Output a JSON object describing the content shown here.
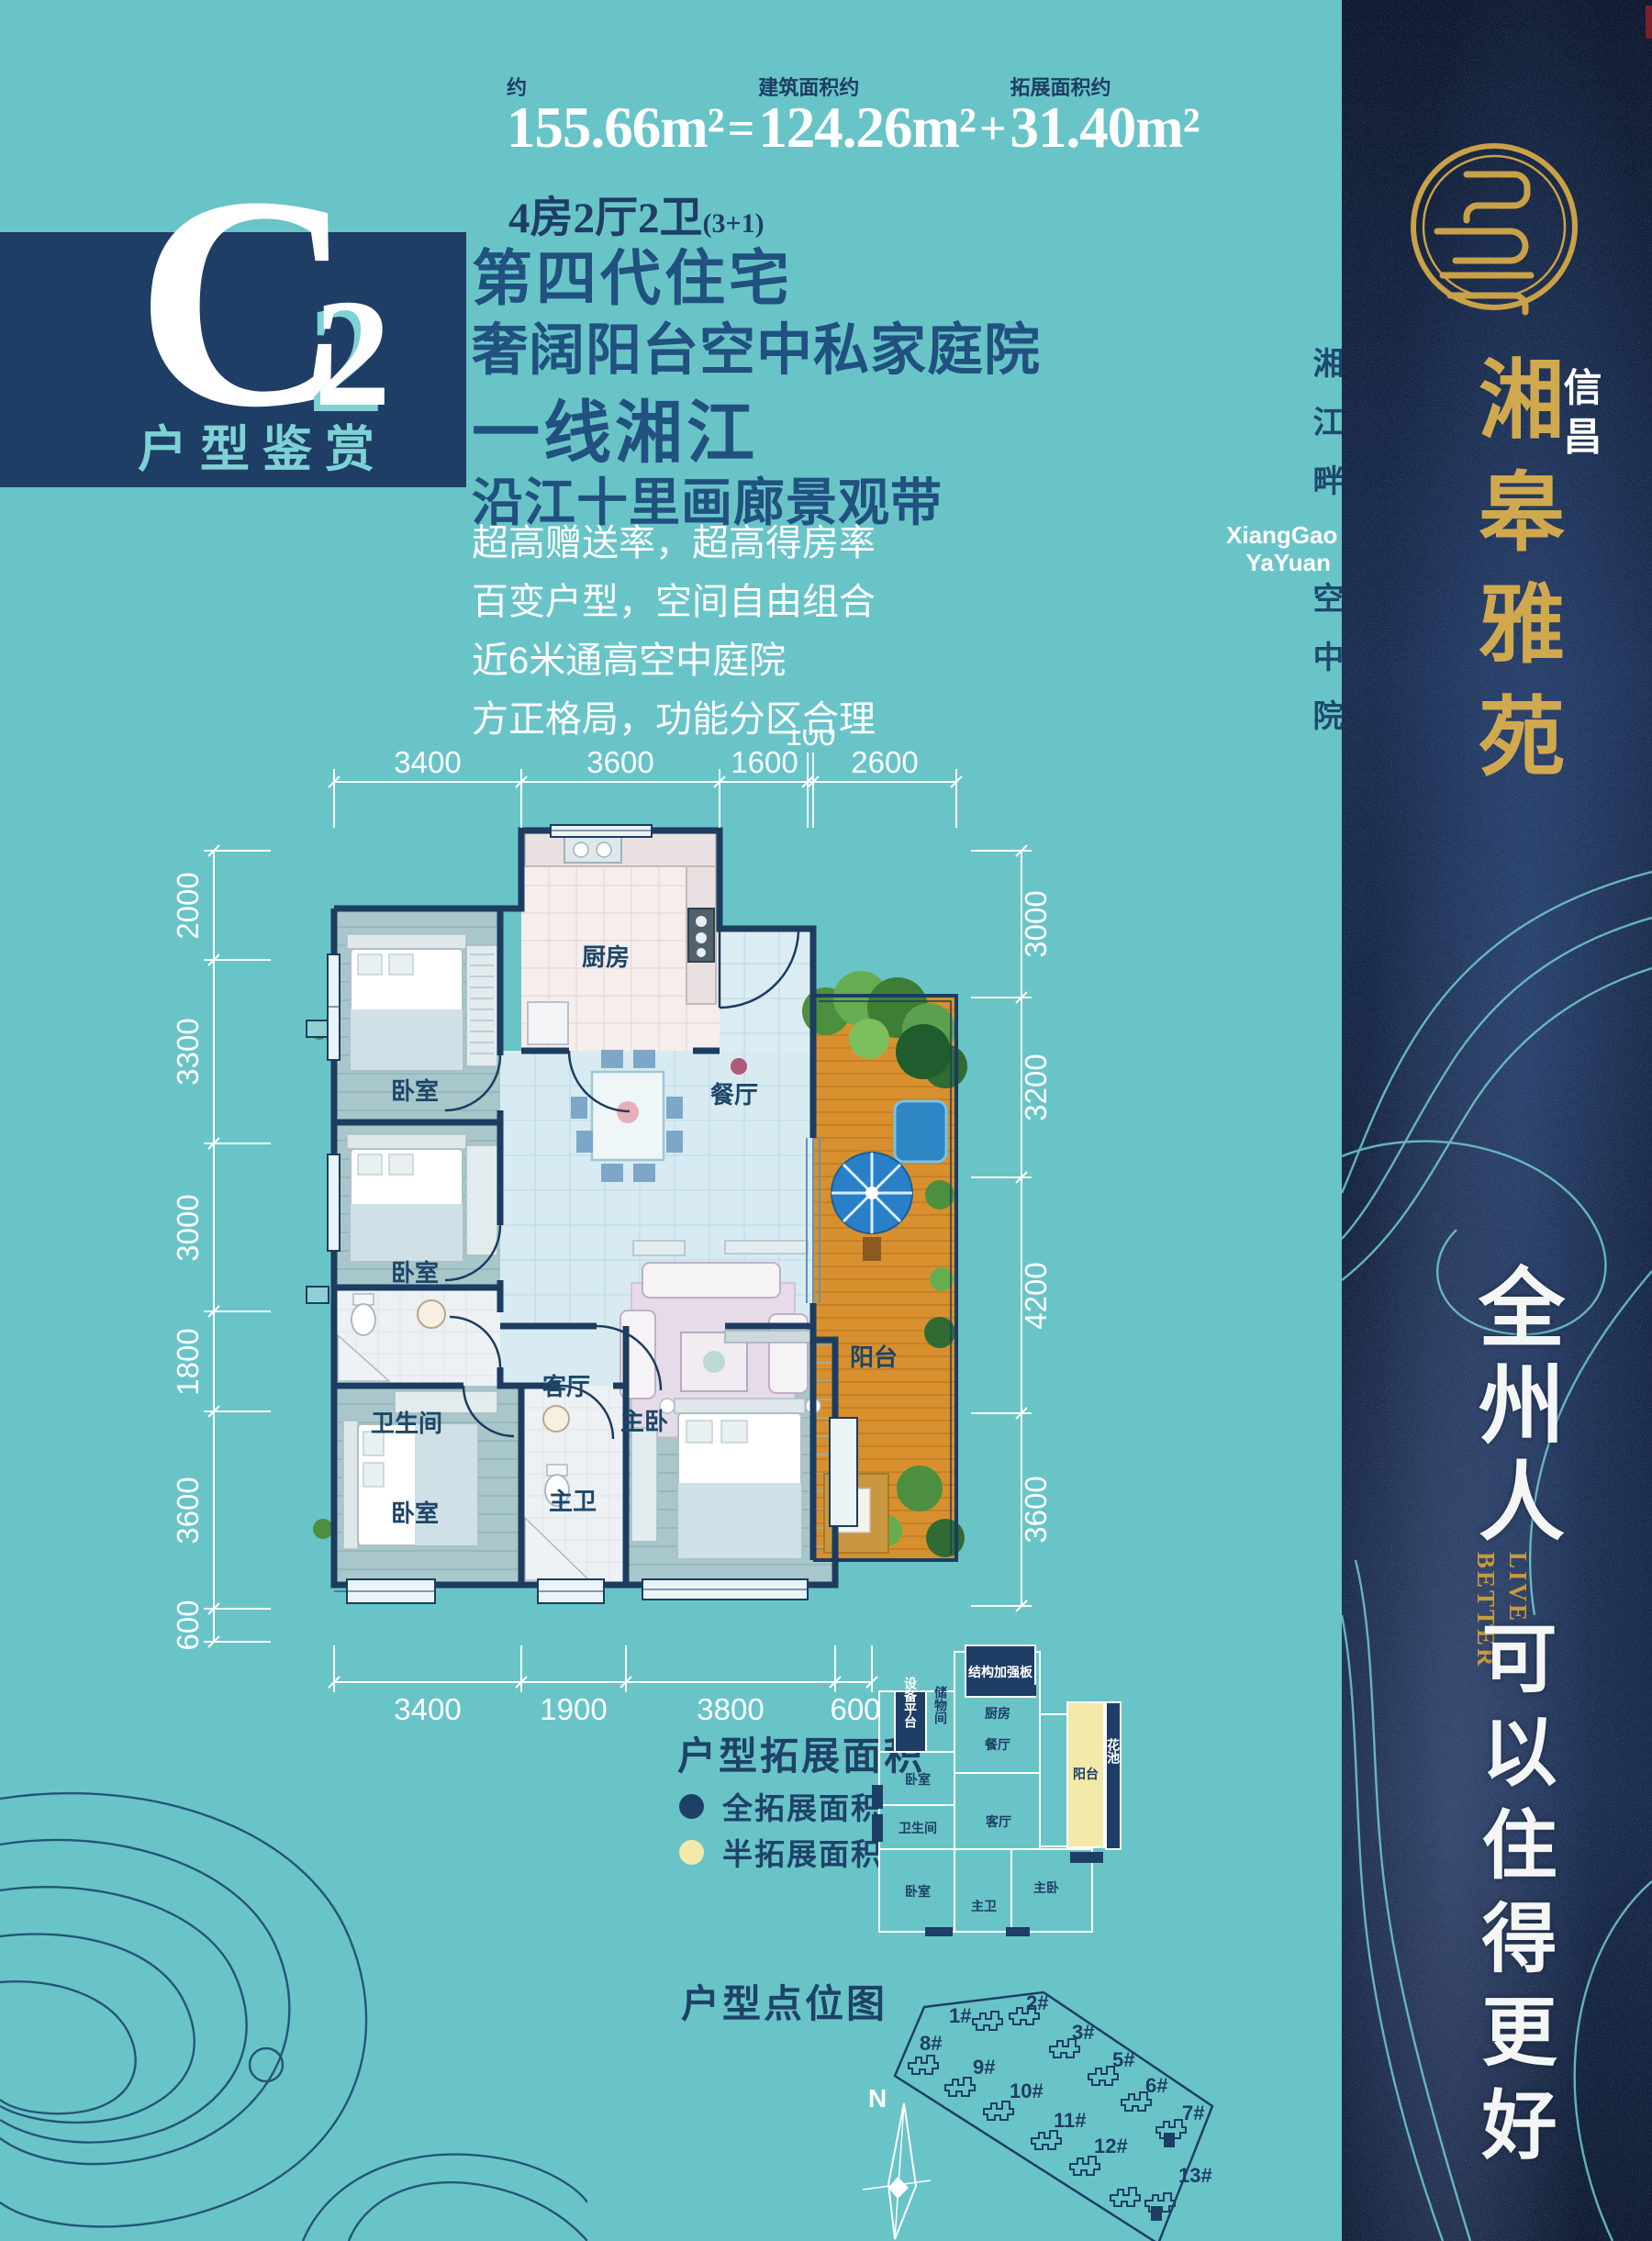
{
  "header": {
    "approx_label": "约",
    "total_area": "155.66m²",
    "equals": "=",
    "build_label": "建筑面积约",
    "build_area": "124.26m²",
    "plus": "+",
    "expand_label": "拓展面积约",
    "expand_area": "31.40m²",
    "layout": "4房2厅2卫",
    "layout_suffix": "(3+1)"
  },
  "emblem": {
    "letter": "C",
    "number": "2",
    "caption": "户型鉴赏"
  },
  "headlines": {
    "line1": "第四代住宅",
    "line2": "奢阔阳台空中私家庭院",
    "line3": "一线湘江",
    "line4": "沿江十里画廊景观带"
  },
  "selling_points": {
    "p1": "超高赠送率，超高得房率",
    "p2": "百变户型，空间自由组合",
    "p3": "近6米通高空中庭院",
    "p4": "方正格局，功能分区合理"
  },
  "floor_plan": {
    "dims_top": [
      "3400",
      "3600",
      "1600",
      "100",
      "2600"
    ],
    "dims_left": [
      "2000",
      "3300",
      "3000",
      "1800",
      "3600",
      "600"
    ],
    "dims_right": [
      "3000",
      "3200",
      "4200",
      "3600"
    ],
    "dims_bottom": [
      "3400",
      "1900",
      "3800",
      "600"
    ],
    "rooms": {
      "kitchen": "厨房",
      "dining": "餐厅",
      "bedroom1": "卧室",
      "bedroom2": "卧室",
      "living": "客厅",
      "balcony": "阳台",
      "bath": "卫生间",
      "bedroom3": "卧室",
      "master_bath": "主卫",
      "master_bedroom": "主卧"
    }
  },
  "legend": {
    "title": "户型拓展面积",
    "full_label": "全拓展面积",
    "full_color": "#1e3f66",
    "half_label": "半拓展面积",
    "half_color": "#f3e9a9"
  },
  "mini_plan": {
    "structure_board": "结构加强板",
    "equipment": "设备平台",
    "storage": "储物间",
    "kitchen": "厨房",
    "dining": "餐厅",
    "bedroom1": "卧室",
    "bath": "卫生间",
    "living": "客厅",
    "balcony": "阳台",
    "flower_bed": "花池",
    "bedroom2": "卧室",
    "master_bath": "主卫",
    "master_bedroom": "主卧"
  },
  "site_plan": {
    "title": "户型点位图",
    "compass": "N",
    "buildings": [
      "1#",
      "2#",
      "3#",
      "5#",
      "6#",
      "7#",
      "8#",
      "9#",
      "10#",
      "11#",
      "12#",
      "13#"
    ]
  },
  "banner": {
    "brand_prefix": "信昌",
    "brand": "湘皋雅苑",
    "brand_en_1": "XiangGao",
    "brand_en_2": "YaYuan",
    "side_text_1": "湘江畔",
    "side_text_2": "空中院",
    "slogan_cn_1": "全州人",
    "slogan_en_1": "LIVE",
    "slogan_en_2": "BETTER",
    "slogan_cn_2": "可以住得更好"
  }
}
